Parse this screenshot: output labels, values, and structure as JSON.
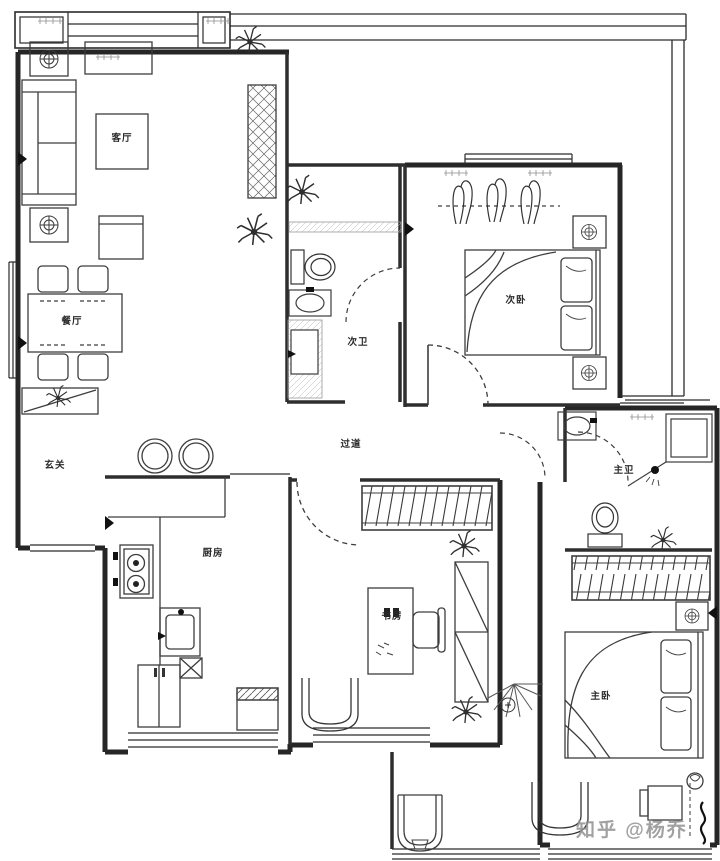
{
  "canvas": {
    "width": 720,
    "height": 861,
    "background": "#ffffff",
    "line_color": "#2b2b2b"
  },
  "floorplan": {
    "type": "apartment-floor-plan",
    "rooms": [
      {
        "id": "living-room",
        "label": "客厅"
      },
      {
        "id": "dining-room",
        "label": "餐厅"
      },
      {
        "id": "entry",
        "label": "玄关"
      },
      {
        "id": "kitchen",
        "label": "厨房"
      },
      {
        "id": "second-bathroom",
        "label": "次卫"
      },
      {
        "id": "hallway",
        "label": "过道"
      },
      {
        "id": "second-bedroom",
        "label": "次卧"
      },
      {
        "id": "study",
        "label": "书房"
      },
      {
        "id": "master-bathroom",
        "label": "主卫"
      },
      {
        "id": "master-bedroom",
        "label": "主卧"
      }
    ],
    "furniture": [
      "sofa",
      "coffee-table",
      "tv-cabinet",
      "side-tables",
      "dining-table",
      "dining-chairs",
      "shoe-cabinet",
      "bar-stools",
      "stove",
      "kitchen-sink",
      "fridge",
      "washing-machine",
      "water-heater",
      "toilets",
      "wash-basins",
      "vanity",
      "double-beds",
      "nightstands",
      "wardrobe",
      "closet",
      "desk",
      "desk-chair",
      "bookcase",
      "armchairs",
      "shower",
      "bathtub-basin",
      "plants",
      "clothes-hangers"
    ]
  },
  "watermark": {
    "text": "知乎 @杨乔",
    "color": "#919191"
  }
}
